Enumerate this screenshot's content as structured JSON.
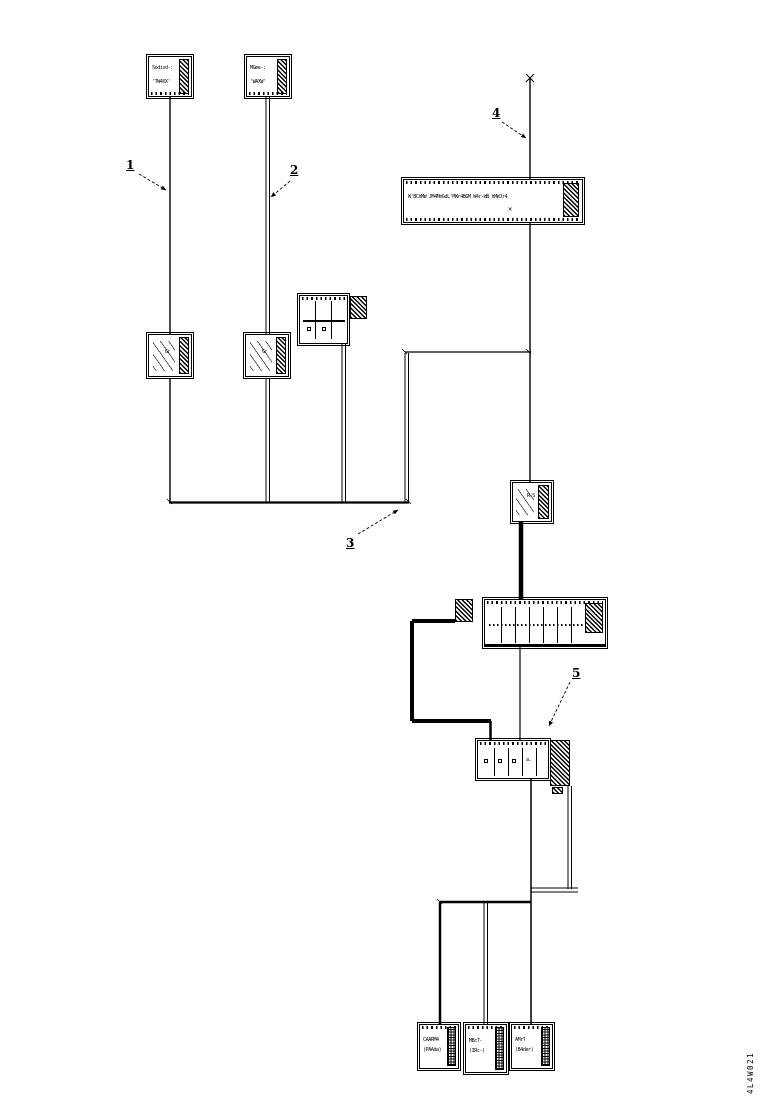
{
  "page": {
    "background": "#ffffff",
    "ink": "#000000"
  },
  "doc_code": "4L4W021",
  "callouts": [
    {
      "label": "1"
    },
    {
      "label": "2"
    },
    {
      "label": "3"
    },
    {
      "label": "4"
    },
    {
      "label": "5"
    }
  ],
  "modules": {
    "top_left": {
      "l1": "Sodivd-:",
      "l2": "'TW4XX'"
    },
    "top_second": {
      "l1": "MGme-:",
      "l2": "'WAXW'"
    },
    "coil_left": {
      "l1": "Gr"
    },
    "coil_second": {
      "l1": "Gr"
    },
    "long_block": {
      "text": "W'BChMW JM4MnGdL'MWr4BGM W4r-WB hMWJr4",
      "xmark": "✕"
    },
    "connector_d": {
      "l1": "R-S"
    },
    "relay_h": {
      "l1": "a."
    },
    "bottom_1": {
      "l1": "CAARM4",
      "l2": "(PAAda)"
    },
    "bottom_2": {
      "l1": "MBc7-",
      "l2": "(IRc-)"
    },
    "bottom_3": {
      "l1": "AMrT",
      "l2": "(B4der)"
    }
  }
}
